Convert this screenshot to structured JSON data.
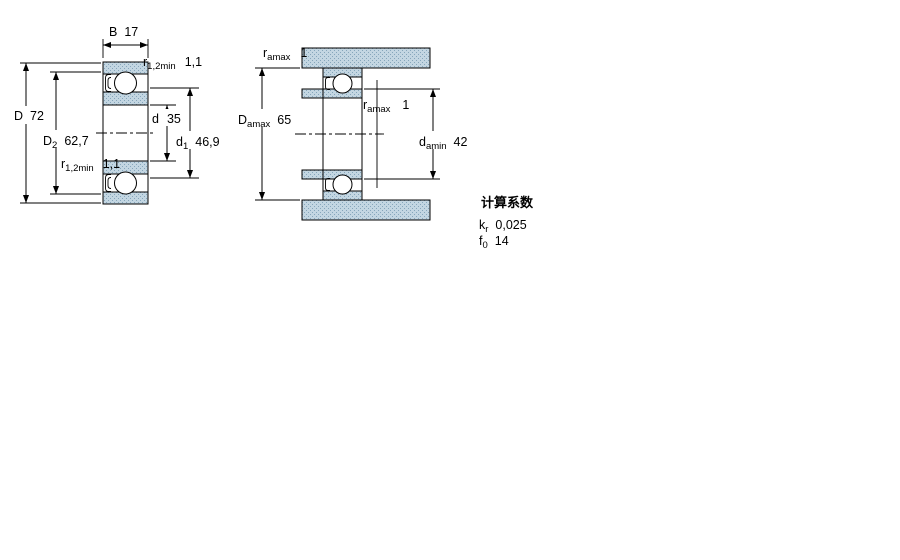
{
  "drawing": {
    "main_view": {
      "dims": {
        "B": {
          "sym": "B",
          "value": "17"
        },
        "r_top": {
          "sym": "r",
          "sub": "1,2min",
          "value": "1,1"
        },
        "D": {
          "sym": "D",
          "value": "72"
        },
        "D2": {
          "sym": "D",
          "sub": "2",
          "value": "62,7"
        },
        "d": {
          "sym": "d",
          "value": "35"
        },
        "d1": {
          "sym": "d",
          "sub": "1",
          "value": "46,9"
        },
        "r_bottom": {
          "sym": "r",
          "sub": "1,2min",
          "value": "1,1"
        }
      }
    },
    "abutment_view": {
      "dims": {
        "ra_top": {
          "sym": "r",
          "sub": "amax",
          "value": "1"
        },
        "Da": {
          "sym": "D",
          "sub": "amax",
          "value": "65"
        },
        "ra_shaft": {
          "sym": "r",
          "sub": "amax",
          "value": "1"
        },
        "da": {
          "sym": "d",
          "sub": "amin",
          "value": "42"
        }
      }
    },
    "calculation_factors": {
      "title": "计算系数",
      "rows": [
        {
          "sym": "k",
          "sub": "r",
          "value": "0,025"
        },
        {
          "sym": "f",
          "sub": "0",
          "value": "14"
        }
      ]
    },
    "colors": {
      "section_fill": "#c3d6e2",
      "section_dot": "#86a6bb",
      "line": "#000000"
    }
  }
}
